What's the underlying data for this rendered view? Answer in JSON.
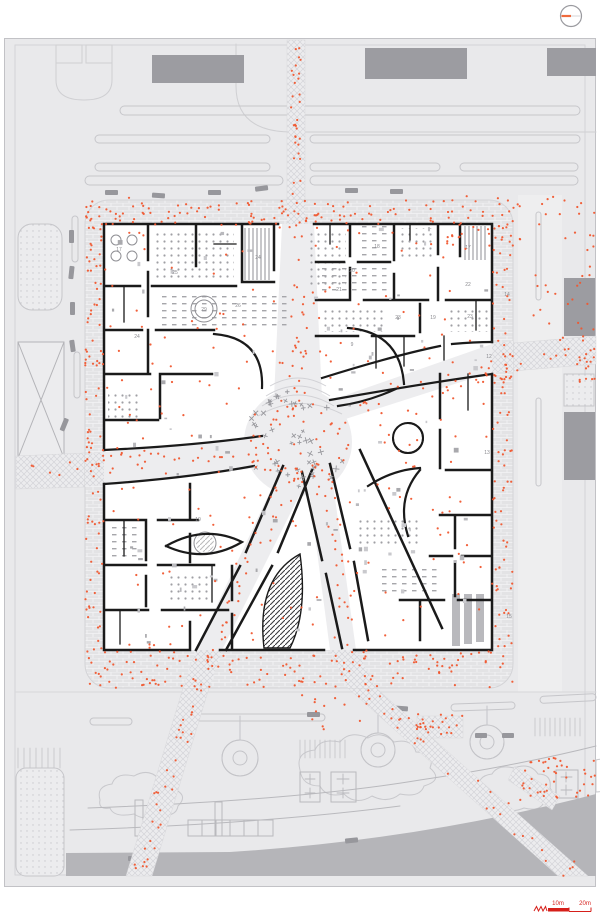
{
  "colors": {
    "background": "#ffffff",
    "site_fill": "#e9e9eb",
    "site_line": "#c7c7cb",
    "frame_line": "#c2c2c6",
    "plan_fill": "#ffffff",
    "paving_fill": "#e3e3e5",
    "street_fill": "#ededef",
    "wall": "#1a1a1a",
    "furniture_gray": "#a3a3a8",
    "building_fill": "#9c9ca1",
    "road_band": "#b5b5b9",
    "people_dot": "#f0572f",
    "scale_red": "#d61f1a",
    "label_gray": "#8a8a8f",
    "north_needle": "#ef6a3c"
  },
  "north_indicator": {
    "icon": "north-circle-icon"
  },
  "scale_bar": {
    "label_10": "10m",
    "label_20": "20m"
  },
  "plan": {
    "room_labels": [
      {
        "text": "17",
        "x": 119,
        "y": 251
      },
      {
        "text": "25",
        "x": 175,
        "y": 274
      },
      {
        "text": "24",
        "x": 258,
        "y": 259
      },
      {
        "text": "26",
        "x": 238,
        "y": 307
      },
      {
        "text": "24",
        "x": 137,
        "y": 338
      },
      {
        "text": "29",
        "x": 204,
        "y": 311
      },
      {
        "text": "18",
        "x": 377,
        "y": 248
      },
      {
        "text": "20",
        "x": 352,
        "y": 272
      },
      {
        "text": "21",
        "x": 339,
        "y": 291
      },
      {
        "text": "17",
        "x": 468,
        "y": 249
      },
      {
        "text": "22",
        "x": 468,
        "y": 286
      },
      {
        "text": "23",
        "x": 470,
        "y": 318
      },
      {
        "text": "19",
        "x": 433,
        "y": 319
      },
      {
        "text": "23",
        "x": 398,
        "y": 319
      },
      {
        "text": "9",
        "x": 352,
        "y": 346
      },
      {
        "text": "10",
        "x": 198,
        "y": 521
      },
      {
        "text": "14",
        "x": 507,
        "y": 296
      },
      {
        "text": "12",
        "x": 489,
        "y": 358
      },
      {
        "text": "13",
        "x": 487,
        "y": 454
      },
      {
        "text": "15",
        "x": 509,
        "y": 618
      }
    ],
    "center_tree_count": 46
  },
  "people": {
    "seed": 7,
    "counts": {
      "ring": 430,
      "streets": 310,
      "interior": 210,
      "context": 190
    }
  }
}
